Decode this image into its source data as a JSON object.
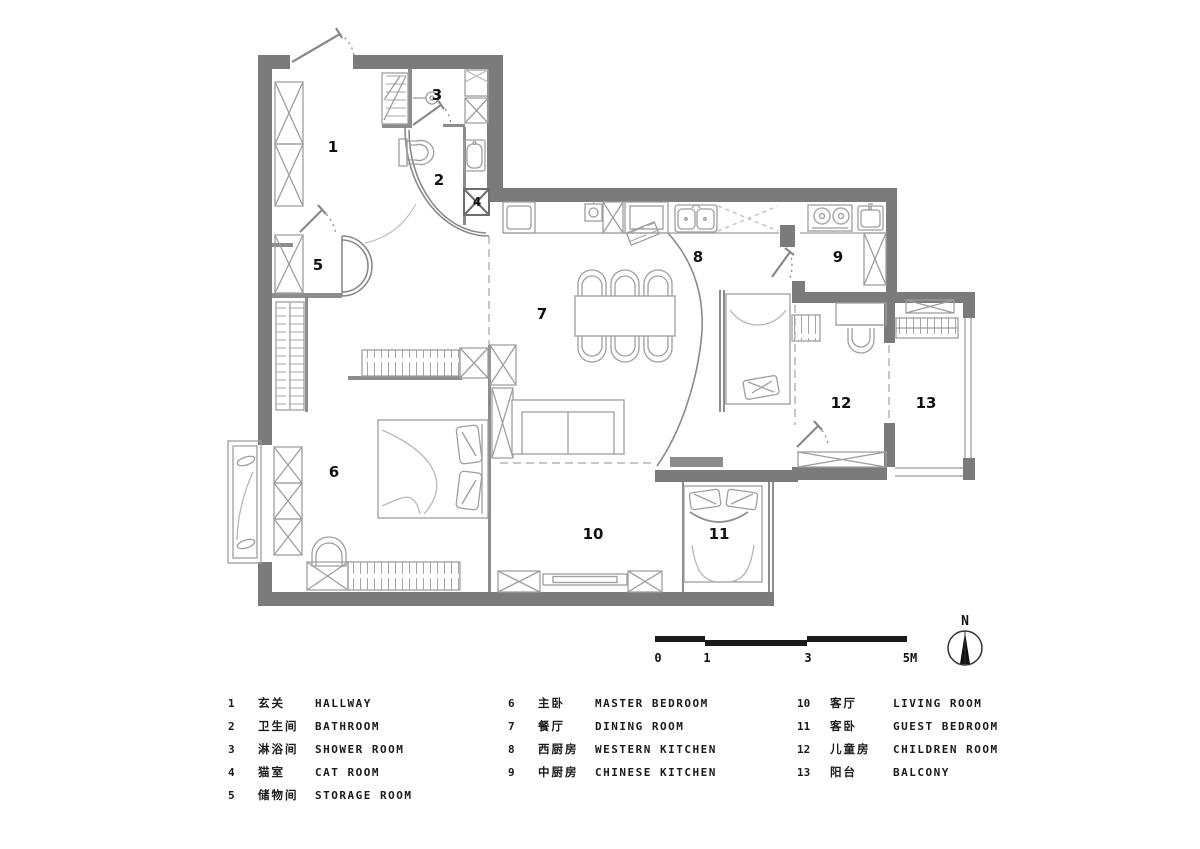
{
  "colors": {
    "wall": "#7b7b7b",
    "thin_wall": "#8c8c8c",
    "furniture_line": "#9e9e9e",
    "dash_line": "#b5b5b5",
    "text": "#111111"
  },
  "rooms": [
    {
      "num": "1",
      "cn": "玄关",
      "en": "HALLWAY"
    },
    {
      "num": "2",
      "cn": "卫生间",
      "en": "BATHROOM"
    },
    {
      "num": "3",
      "cn": "淋浴间",
      "en": "SHOWER ROOM"
    },
    {
      "num": "4",
      "cn": "猫室",
      "en": "CAT ROOM"
    },
    {
      "num": "5",
      "cn": "储物间",
      "en": "STORAGE ROOM"
    },
    {
      "num": "6",
      "cn": "主卧",
      "en": "MASTER BEDROOM"
    },
    {
      "num": "7",
      "cn": "餐厅",
      "en": "DINING ROOM"
    },
    {
      "num": "8",
      "cn": "西厨房",
      "en": "WESTERN KITCHEN"
    },
    {
      "num": "9",
      "cn": "中厨房",
      "en": "CHINESE KITCHEN"
    },
    {
      "num": "10",
      "cn": "客厅",
      "en": "LIVING ROOM"
    },
    {
      "num": "11",
      "cn": "客卧",
      "en": "GUEST BEDROOM"
    },
    {
      "num": "12",
      "cn": "儿童房",
      "en": "CHILDREN ROOM"
    },
    {
      "num": "13",
      "cn": "阳台",
      "en": "BALCONY"
    }
  ],
  "scale_bar": {
    "ticks": [
      "0",
      "1",
      "3",
      "5M"
    ]
  },
  "north": {
    "label": "N"
  }
}
